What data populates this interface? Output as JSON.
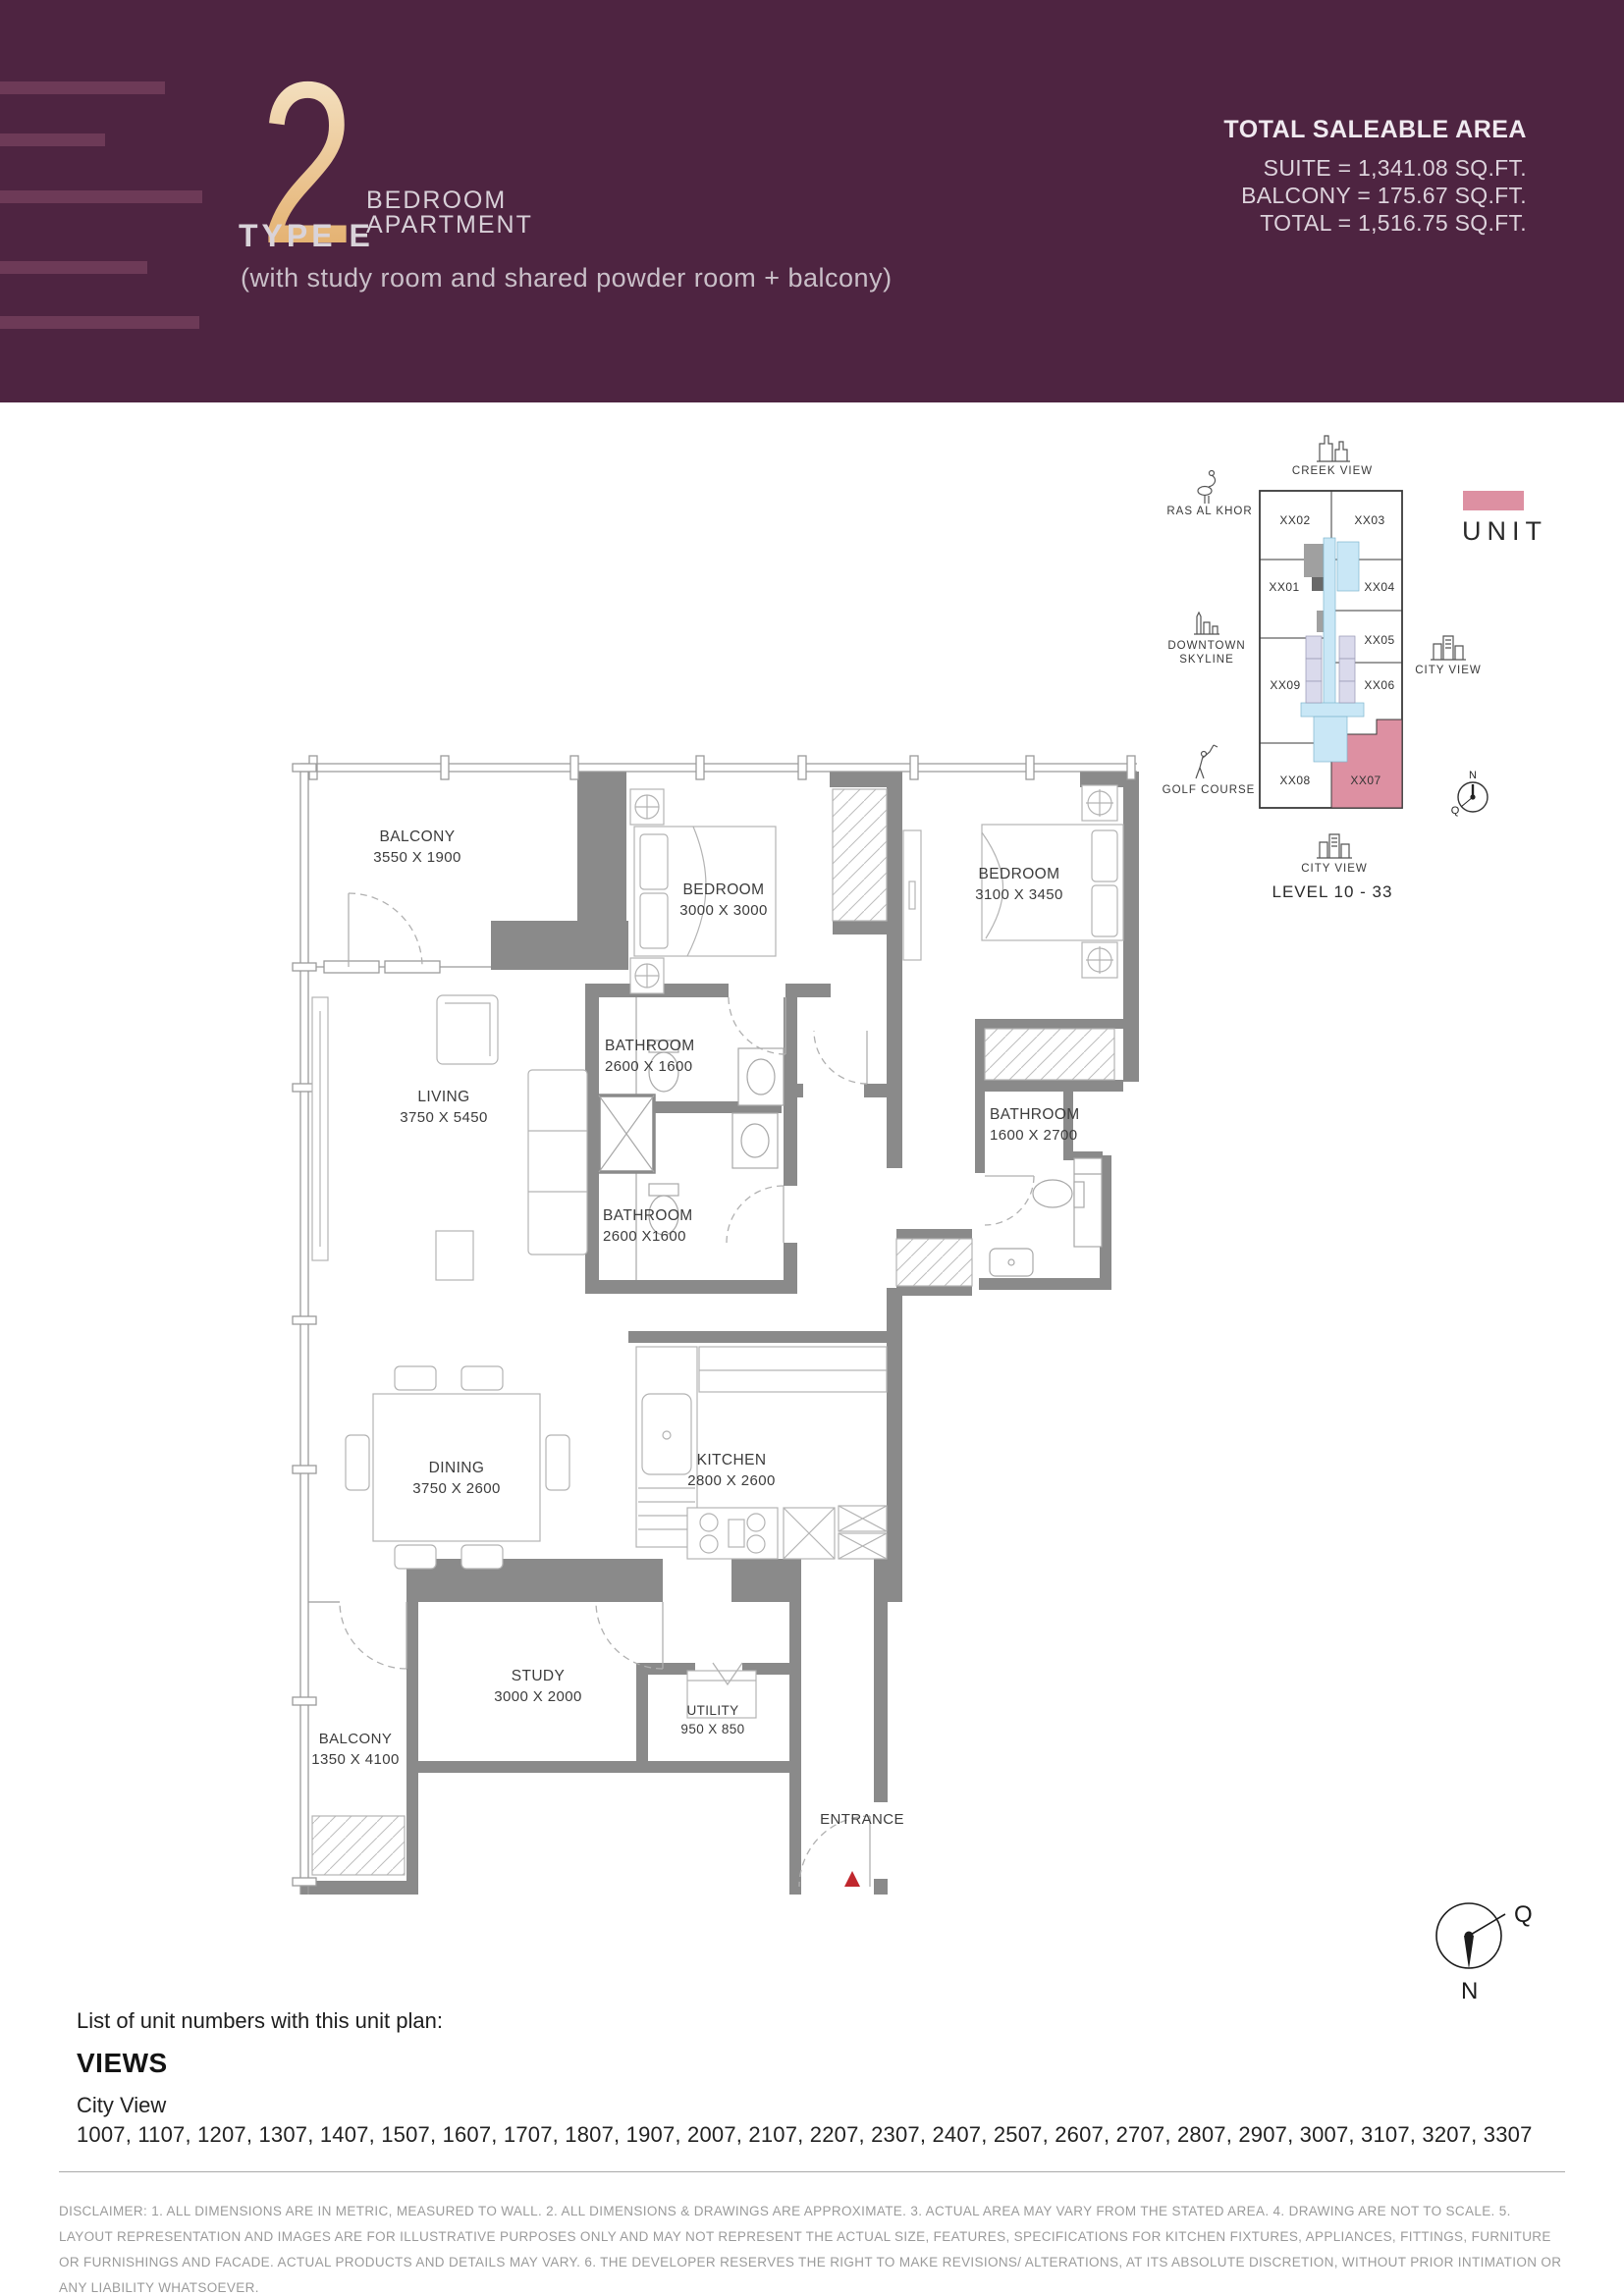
{
  "header": {
    "number": "2",
    "title_line1": "BEDROOM",
    "title_line2": "APARTMENT",
    "type_label": "TYPE E",
    "subtitle": "(with study room and shared powder room + balcony)",
    "area_heading": "TOTAL SALEABLE AREA",
    "area_lines": [
      "SUITE = 1,341.08 SQ.FT.",
      "BALCONY = 175.67 SQ.FT.",
      "TOTAL = 1,516.75 SQ.FT."
    ]
  },
  "key_plan": {
    "legend_label": "UNIT",
    "level_label": "LEVEL 10 - 33",
    "highlighted_unit": "XX07",
    "views": {
      "creek": "CREEK VIEW",
      "ras_al_khor": "RAS AL KHOR",
      "downtown_line1": "DOWNTOWN",
      "downtown_line2": "SKYLINE",
      "golf": "GOLF COURSE",
      "city_right": "CITY VIEW",
      "city_bottom": "CITY VIEW"
    },
    "units": [
      "XX02",
      "XX03",
      "XX01",
      "XX04",
      "XX05",
      "XX09",
      "XX06",
      "XX08",
      "XX07"
    ],
    "compass": {
      "north": "N",
      "qibla": "Q"
    }
  },
  "floor_plan": {
    "rooms": [
      {
        "name": "BALCONY",
        "dim": "3550 X 1900"
      },
      {
        "name": "BEDROOM",
        "dim": "3000 X 3000"
      },
      {
        "name": "BEDROOM",
        "dim": "3100 X 3450"
      },
      {
        "name": "BATHROOM",
        "dim": "2600 X 1600"
      },
      {
        "name": "BATHROOM",
        "dim": "2600 X1600"
      },
      {
        "name": "BATHROOM",
        "dim": "1600 X 2700"
      },
      {
        "name": "LIVING",
        "dim": "3750 X 5450"
      },
      {
        "name": "DINING",
        "dim": "3750 X 2600"
      },
      {
        "name": "KITCHEN",
        "dim": "2800 X 2600"
      },
      {
        "name": "STUDY",
        "dim": "3000 X 2000"
      },
      {
        "name": "UTILITY",
        "dim": "950 X 850"
      },
      {
        "name": "BALCONY",
        "dim": "1350 X 4100"
      },
      {
        "name": "ENTRANCE",
        "dim": ""
      }
    ],
    "compass": {
      "north": "N",
      "qibla": "Q"
    }
  },
  "footer": {
    "list_label": "List of unit numbers with this unit plan:",
    "views_heading": "VIEWS",
    "view_name": "City View",
    "unit_numbers": "1007, 1107, 1207, 1307, 1407, 1507, 1607, 1707, 1807, 1907, 2007, 2107, 2207, 2307, 2407, 2507, 2607, 2707, 2807, 2907, 3007, 3107, 3207, 3307",
    "disclaimer": "DISCLAIMER: 1. ALL DIMENSIONS ARE IN METRIC, MEASURED TO WALL. 2. ALL DIMENSIONS & DRAWINGS ARE APPROXIMATE.  3. ACTUAL AREA MAY VARY FROM THE STATED AREA. 4. DRAWING ARE NOT TO SCALE. 5. LAYOUT REPRESENTATION AND IMAGES ARE FOR ILLUSTRATIVE PURPOSES ONLY AND MAY NOT REPRESENT THE ACTUAL SIZE, FEATURES, SPECIFICATIONS FOR KITCHEN FIXTURES, APPLIANCES, FITTINGS, FURNITURE OR FURNISHINGS AND FACADE. ACTUAL PRODUCTS AND DETAILS MAY VARY. 6. THE DEVELOPER RESERVES THE RIGHT TO MAKE REVISIONS/ ALTERATIONS, AT ITS ABSOLUTE DISCRETION, WITHOUT PRIOR INTIMATION OR ANY LIABILITY WHATSOEVER."
  },
  "colors": {
    "header_bg": "#4e2441",
    "header_stripe": "#6d3a57",
    "numeral_gold_top": "#f8ecd4",
    "numeral_gold_bottom": "#e0a55c",
    "unit_pink": "#dd90a2",
    "core_blue": "#c9e7f6",
    "elevator_lavender": "#dadaec",
    "wall_gray": "#8a8a8a",
    "entrance_marker_red": "#c0272d"
  }
}
